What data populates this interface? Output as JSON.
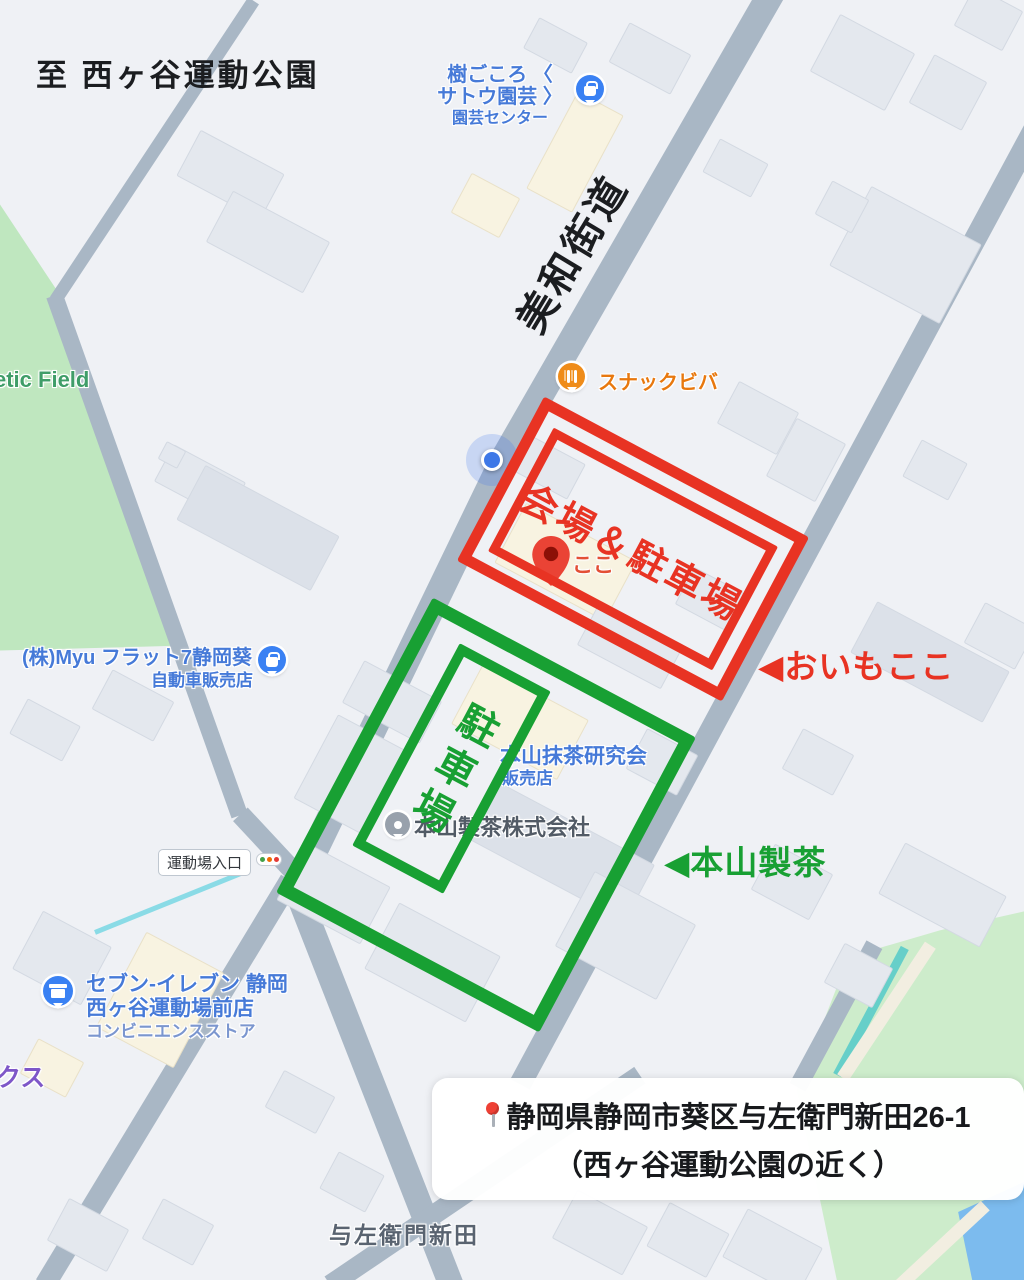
{
  "annotations": {
    "to_park": "至 西ヶ谷運動公園",
    "road_name": "美和街道",
    "venue_box_label": "会場＆駐車場",
    "venue_callout": "◀おいもここ",
    "parking_box_label": "駐車場",
    "parking_callout": "◀本山製茶",
    "address_line1": "静岡県静岡市葵区与左衛門新田26-1",
    "address_line2": "（西ヶ谷運動公園の近く）"
  },
  "pois": {
    "garden_center": {
      "lines": [
        "樹ごころ 〈",
        "サトウ園芸 〉",
        "園芸センター"
      ]
    },
    "snack": {
      "name": "スナックビバ"
    },
    "myu": {
      "name": "(株)Myu フラット7静岡葵",
      "category": "自動車販売店"
    },
    "matcha": {
      "name": "本山抹茶研究会",
      "category": "販売店"
    },
    "motoyama": {
      "name": "本山製茶株式会社"
    },
    "bus_stop": {
      "name": "運動場入口"
    },
    "seven_eleven": {
      "line1": "セブン-イレブン 静岡",
      "line2": "西ヶ谷運動場前店",
      "category": "コンビニエンスストア"
    },
    "pinned_partial": "ここ",
    "athletic_field_partial": "etic Field",
    "purple_partial": "クス",
    "district": "与左衛門新田"
  },
  "colors": {
    "overlay_red": "#e83323",
    "overlay_green": "#18a033",
    "poi_blue": "#467ad8",
    "poi_blue_light": "#7b96cf",
    "poi_orange": "#e8780e",
    "road_gray": "#a9b7c5",
    "park_green": "#bfe7bf",
    "field_green": "#cdeccb",
    "water_blue": "#7cbbee",
    "label_gray": "#596370"
  }
}
